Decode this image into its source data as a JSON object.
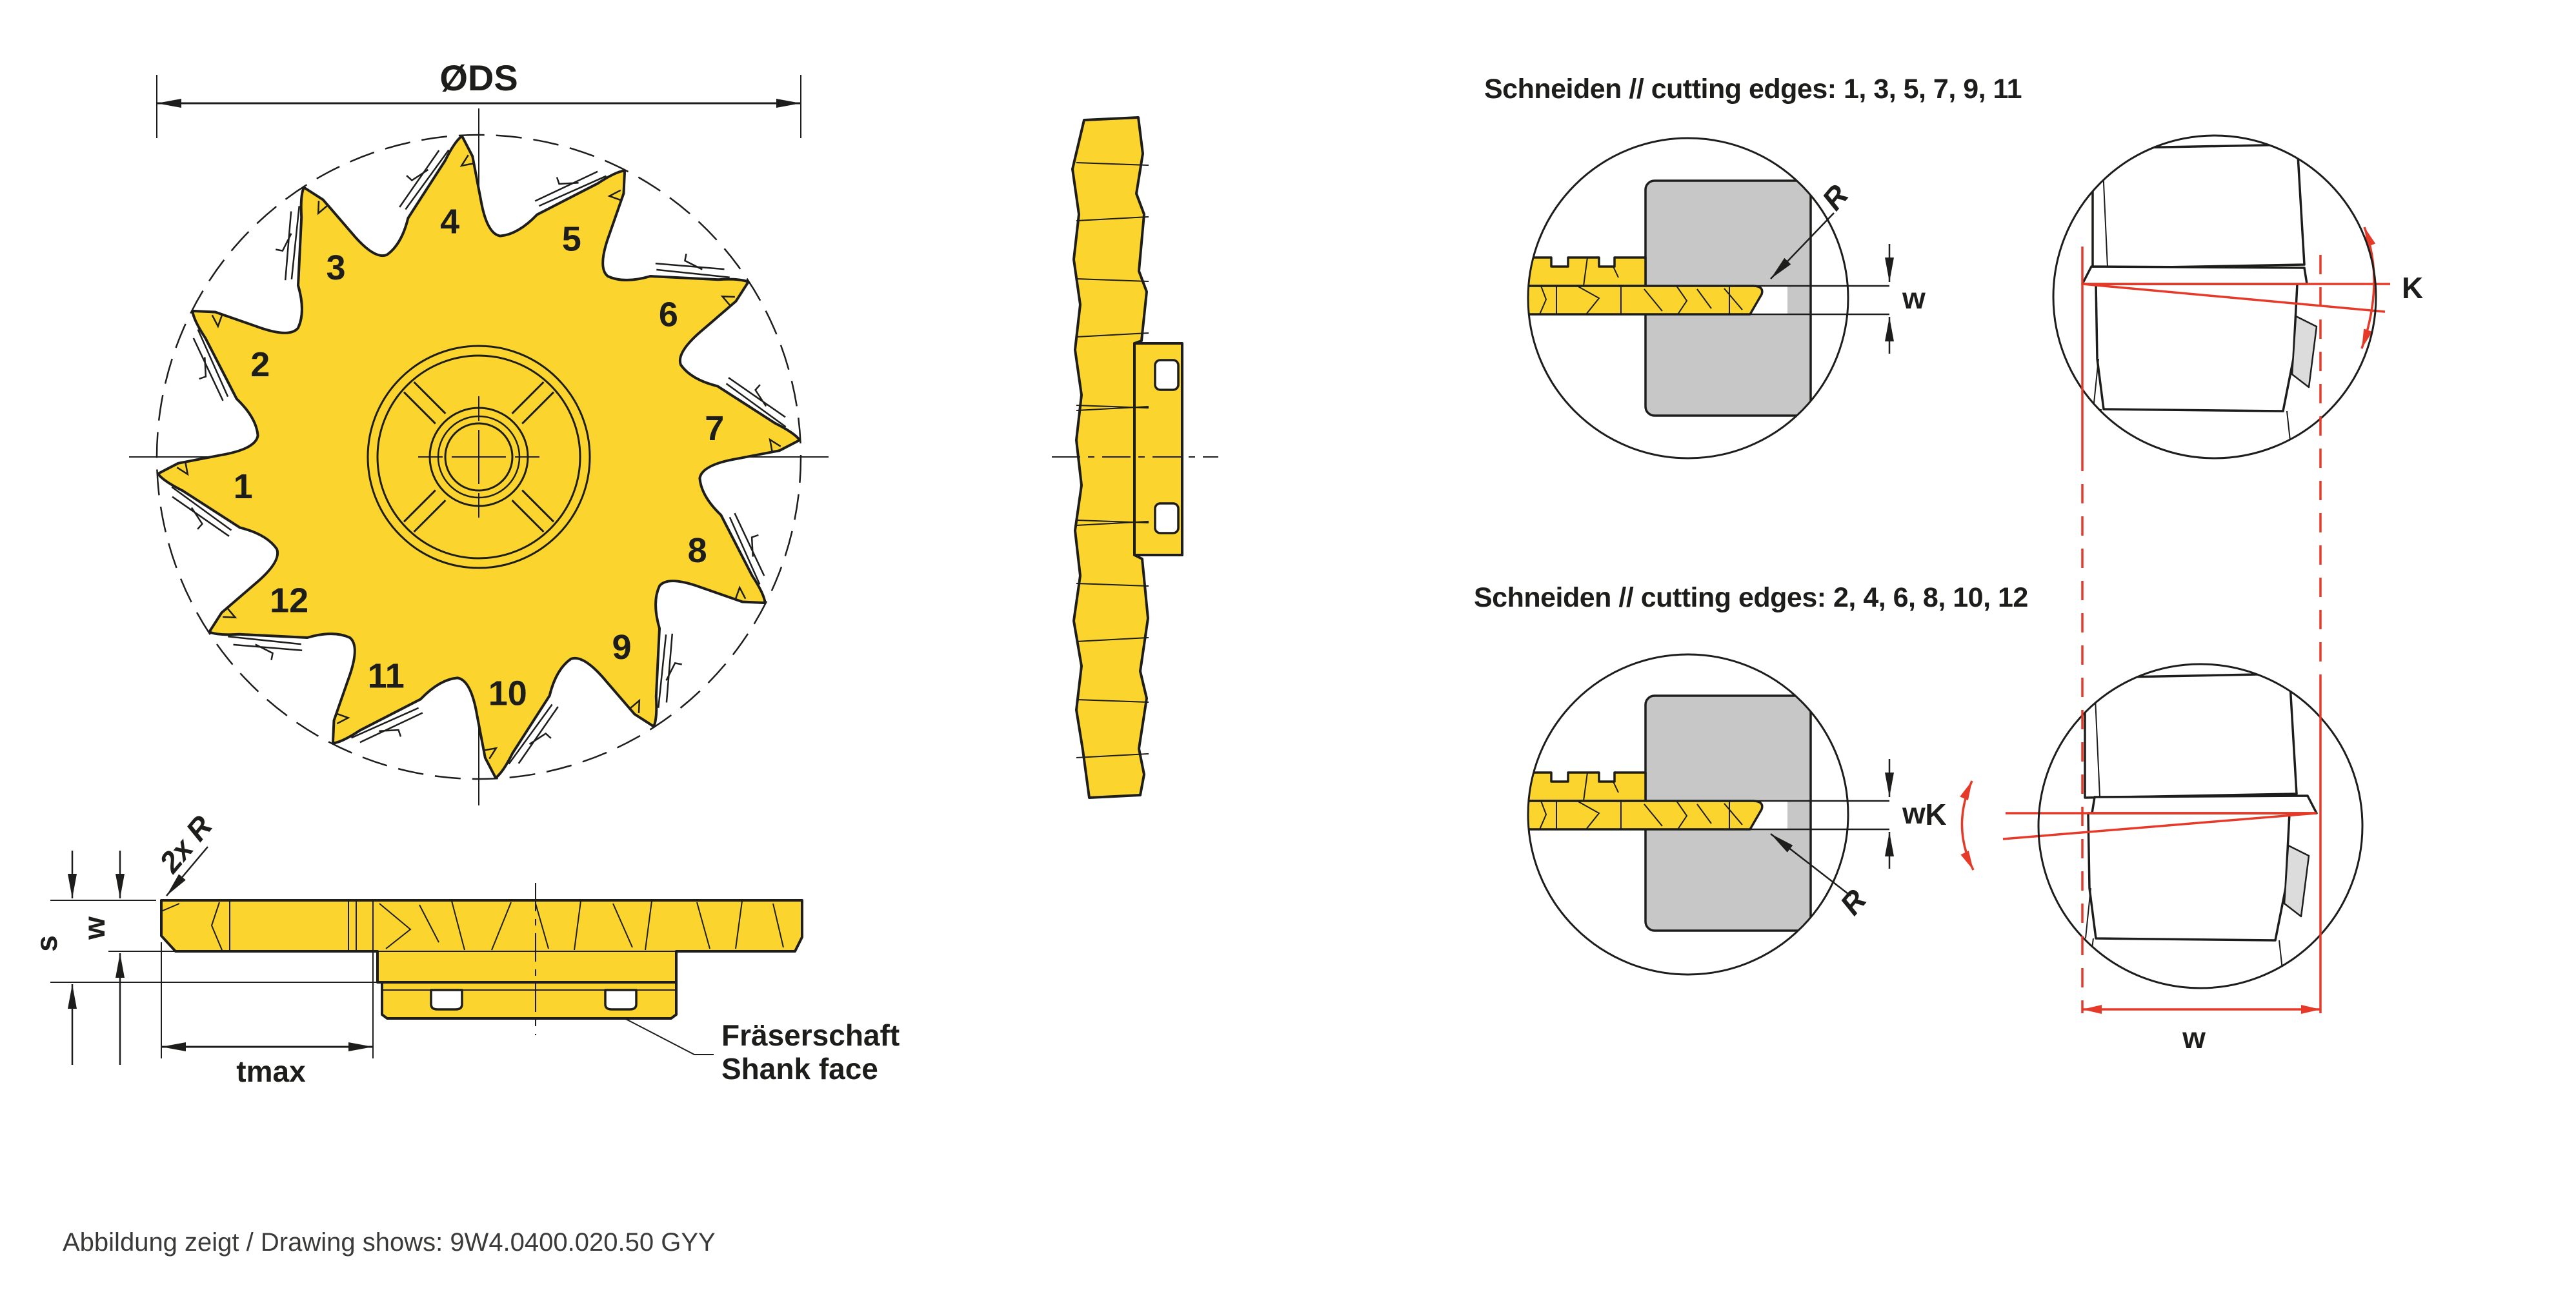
{
  "titles": {
    "edges_odd": "Schneiden // cutting edges: 1, 3, 5, 7, 9, 11",
    "edges_even": "Schneiden // cutting edges: 2, 4, 6, 8, 10, 12"
  },
  "caption": "Abbildung zeigt / Drawing shows: 9W4.0400.020.50 GYY",
  "dims": {
    "diameter": "ØDS",
    "tmax": "tmax",
    "thickness": "s",
    "width": "w",
    "radius": "R",
    "radius_note": "2x R",
    "angle": "K"
  },
  "labels": {
    "shank_de": "Fräserschaft",
    "shank_en": "Shank face"
  },
  "blade": {
    "tooth_count": 12,
    "teeth": [
      "1",
      "2",
      "3",
      "4",
      "5",
      "6",
      "7",
      "8",
      "9",
      "10",
      "11",
      "12"
    ]
  },
  "colors": {
    "tool_yellow": "#FBD42E",
    "workpiece_gray": "#C7C7C7",
    "detail_gray": "#DCDCDC",
    "accent_red": "#E63928",
    "line_black": "#1D1D1B",
    "caption_gray": "#3A3A39"
  }
}
